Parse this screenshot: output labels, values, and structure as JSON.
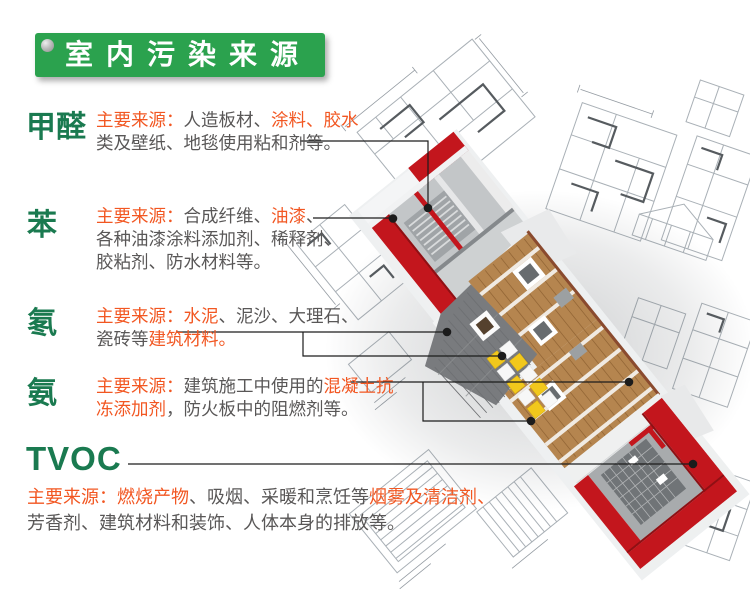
{
  "header": {
    "title": "室内污染来源"
  },
  "colors": {
    "banner_green": "#2ba24e",
    "label_green": "#1a7a50",
    "highlight_orange": "#f25722",
    "body_gray": "#595757",
    "wall_red": "#c3161d",
    "roof_gray": "#797b7e",
    "wood_brown": "#b5854f",
    "insulation_yellow": "#f2c81c"
  },
  "sections": [
    {
      "id": "formaldehyde",
      "label": "甲醛",
      "lines": [
        [
          {
            "t": "主要来源：",
            "c": "orange"
          },
          {
            "t": "人造板材、",
            "c": "gray"
          },
          {
            "t": "涂料、胶水",
            "c": "orange"
          }
        ],
        [
          {
            "t": "类及壁纸、地毯使用粘和剂等。",
            "c": "gray"
          }
        ]
      ]
    },
    {
      "id": "benzene",
      "label": "苯",
      "lines": [
        [
          {
            "t": "主要来源：",
            "c": "orange"
          },
          {
            "t": "合成纤维、",
            "c": "gray"
          },
          {
            "t": "油漆",
            "c": "orange"
          },
          {
            "t": "、",
            "c": "gray"
          }
        ],
        [
          {
            "t": "各种油漆涂料添加剂、稀释剂、",
            "c": "gray"
          }
        ],
        [
          {
            "t": "胶粘剂、防水材料等。",
            "c": "gray"
          }
        ]
      ]
    },
    {
      "id": "radon",
      "label": "氡",
      "lines": [
        [
          {
            "t": "主要来源：水泥",
            "c": "orange"
          },
          {
            "t": "、泥沙、大理石、",
            "c": "gray"
          }
        ],
        [
          {
            "t": "瓷砖等",
            "c": "gray"
          },
          {
            "t": "建筑材料。",
            "c": "orange"
          }
        ]
      ]
    },
    {
      "id": "ammonia",
      "label": "氨",
      "lines": [
        [
          {
            "t": "主要来源：",
            "c": "orange"
          },
          {
            "t": "建筑施工中使用的",
            "c": "gray"
          },
          {
            "t": "混凝土抗",
            "c": "orange"
          }
        ],
        [
          {
            "t": "冻添加剂",
            "c": "orange"
          },
          {
            "t": "，防火板中的阻燃剂等。",
            "c": "gray"
          }
        ]
      ]
    },
    {
      "id": "tvoc",
      "label": "TVOC",
      "lines": [
        [
          {
            "t": "主要来源：燃烧产物",
            "c": "orange"
          },
          {
            "t": "、吸烟、采暖和烹饪等",
            "c": "gray"
          },
          {
            "t": "烟雾及清洁剂、",
            "c": "orange"
          }
        ],
        [
          {
            "t": "芳香剂、建筑材料和装饰、人体本身的排放等。",
            "c": "gray"
          }
        ]
      ]
    }
  ]
}
